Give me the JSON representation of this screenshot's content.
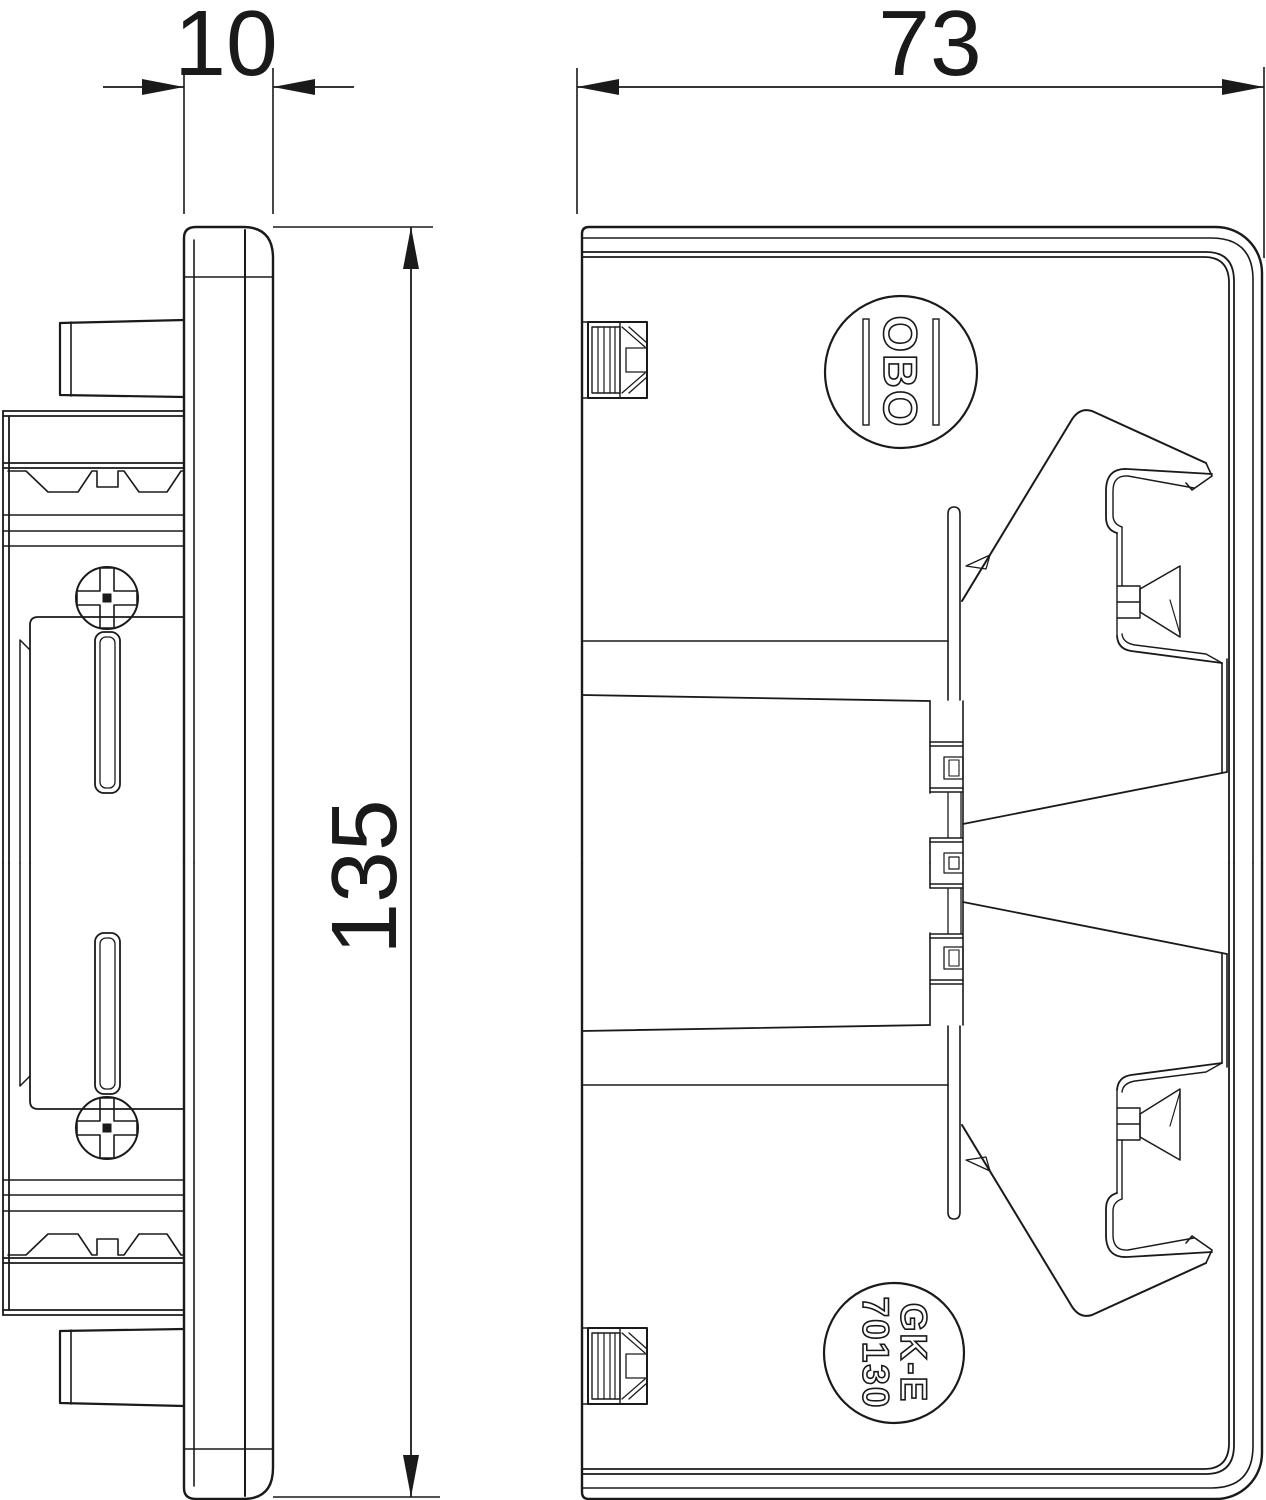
{
  "drawing": {
    "title": "Device installation trunking end piece - dimension drawing",
    "views": [
      "side-profile",
      "front-elevation"
    ],
    "units": "mm"
  },
  "dimensions": {
    "cover_width": "10",
    "body_width": "73",
    "height": "135"
  },
  "labels": {
    "brand": "OBO",
    "part_line1": "GK-E",
    "part_line2": "70130"
  },
  "colors": {
    "line": "#1a1a1a",
    "background": "#ffffff"
  }
}
